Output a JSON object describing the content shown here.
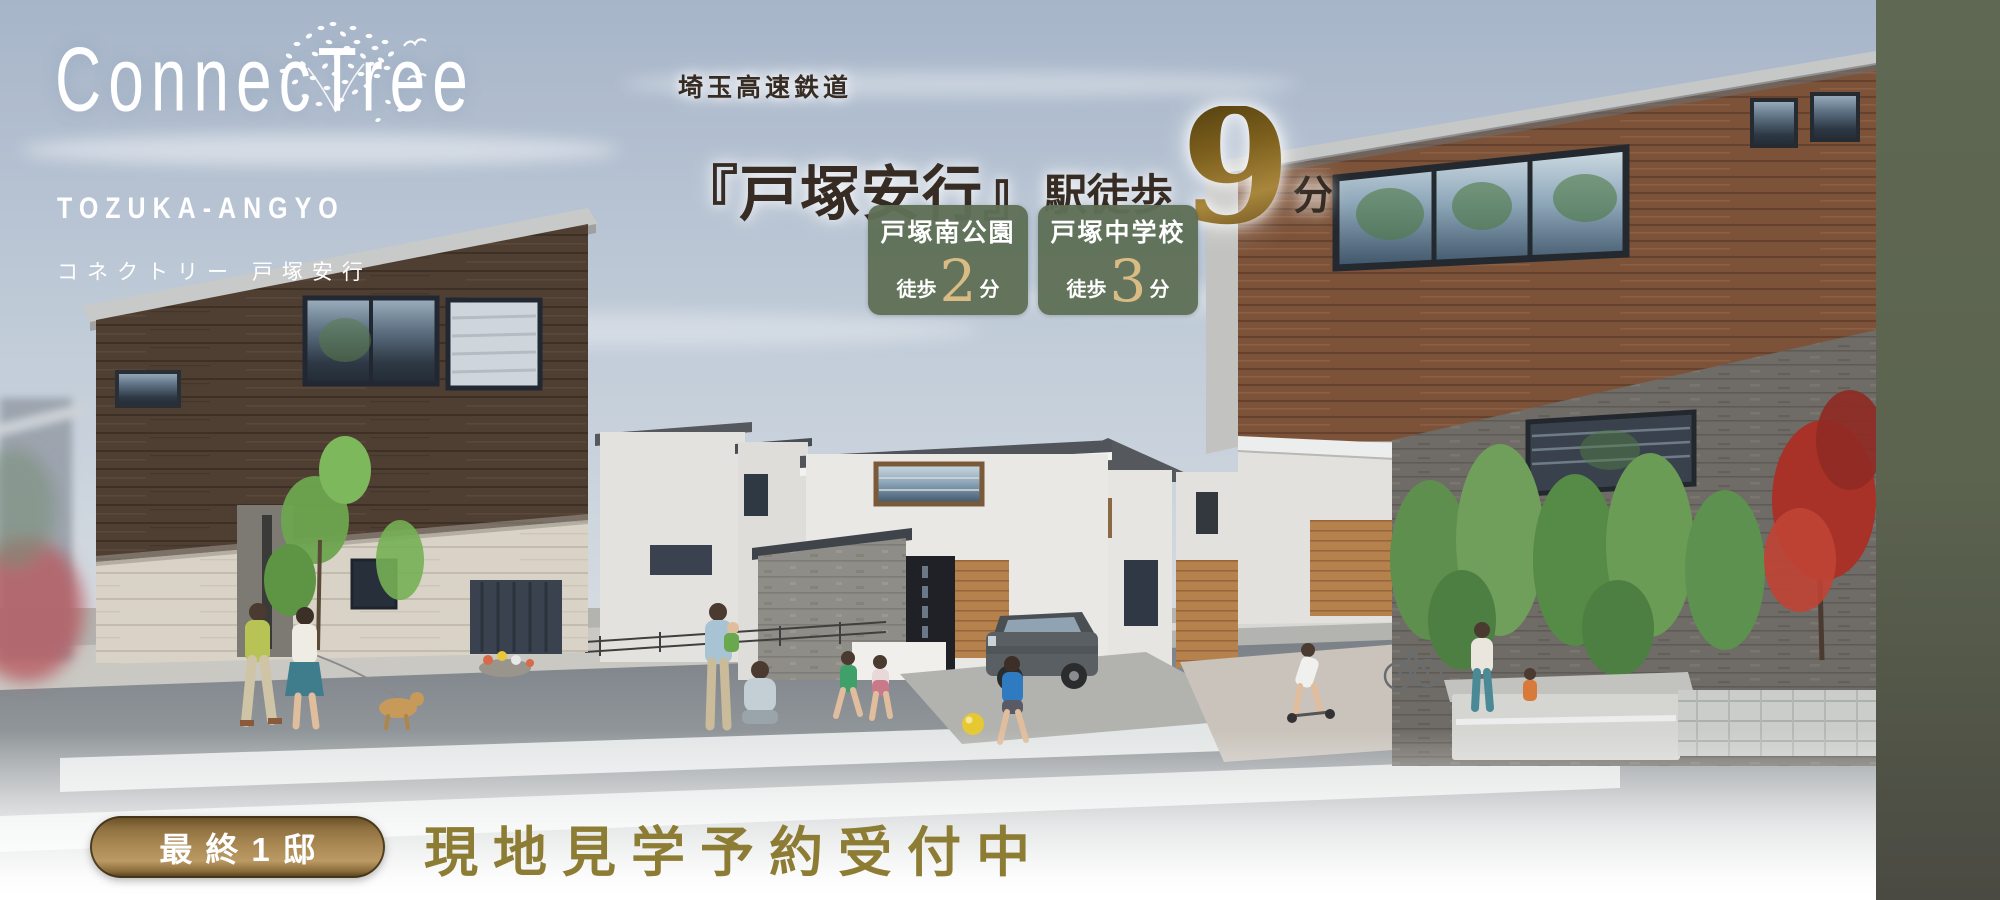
{
  "logo": {
    "name_pre_t": "Connec",
    "name_t": "T",
    "name_post_t": "ree",
    "romaji": "TOZUKA-ANGYO",
    "kana": "コネクトリー 戸塚安行"
  },
  "access": {
    "railway": "埼玉高速鉄道",
    "station": "『戸塚安行』",
    "walk_prefix": "駅徒歩",
    "walk_minutes": "9",
    "walk_unit": "分"
  },
  "poi_badges": [
    {
      "name": "戸塚南公園",
      "walk_label": "徒歩",
      "minutes": "2",
      "unit": "分"
    },
    {
      "name": "戸塚中学校",
      "walk_label": "徒歩",
      "minutes": "3",
      "unit": "分"
    }
  ],
  "footer": {
    "availability_badge": "最終1邸",
    "cta_message": "現地見学予約受付中"
  },
  "colors": {
    "badge_green": "#5f6f56",
    "badge_number_gold": "#d9bc83",
    "big_number_gold": "#8a6c28",
    "headline_dark": "#362c24",
    "pill_gold_light": "#bb9a64",
    "pill_gold_dark": "#6b5228",
    "footer_text_gold": "#8d7c33",
    "sidebar_top": "#5f6853",
    "sidebar_bottom": "#4a4a42",
    "logo_white": "#ffffff"
  }
}
